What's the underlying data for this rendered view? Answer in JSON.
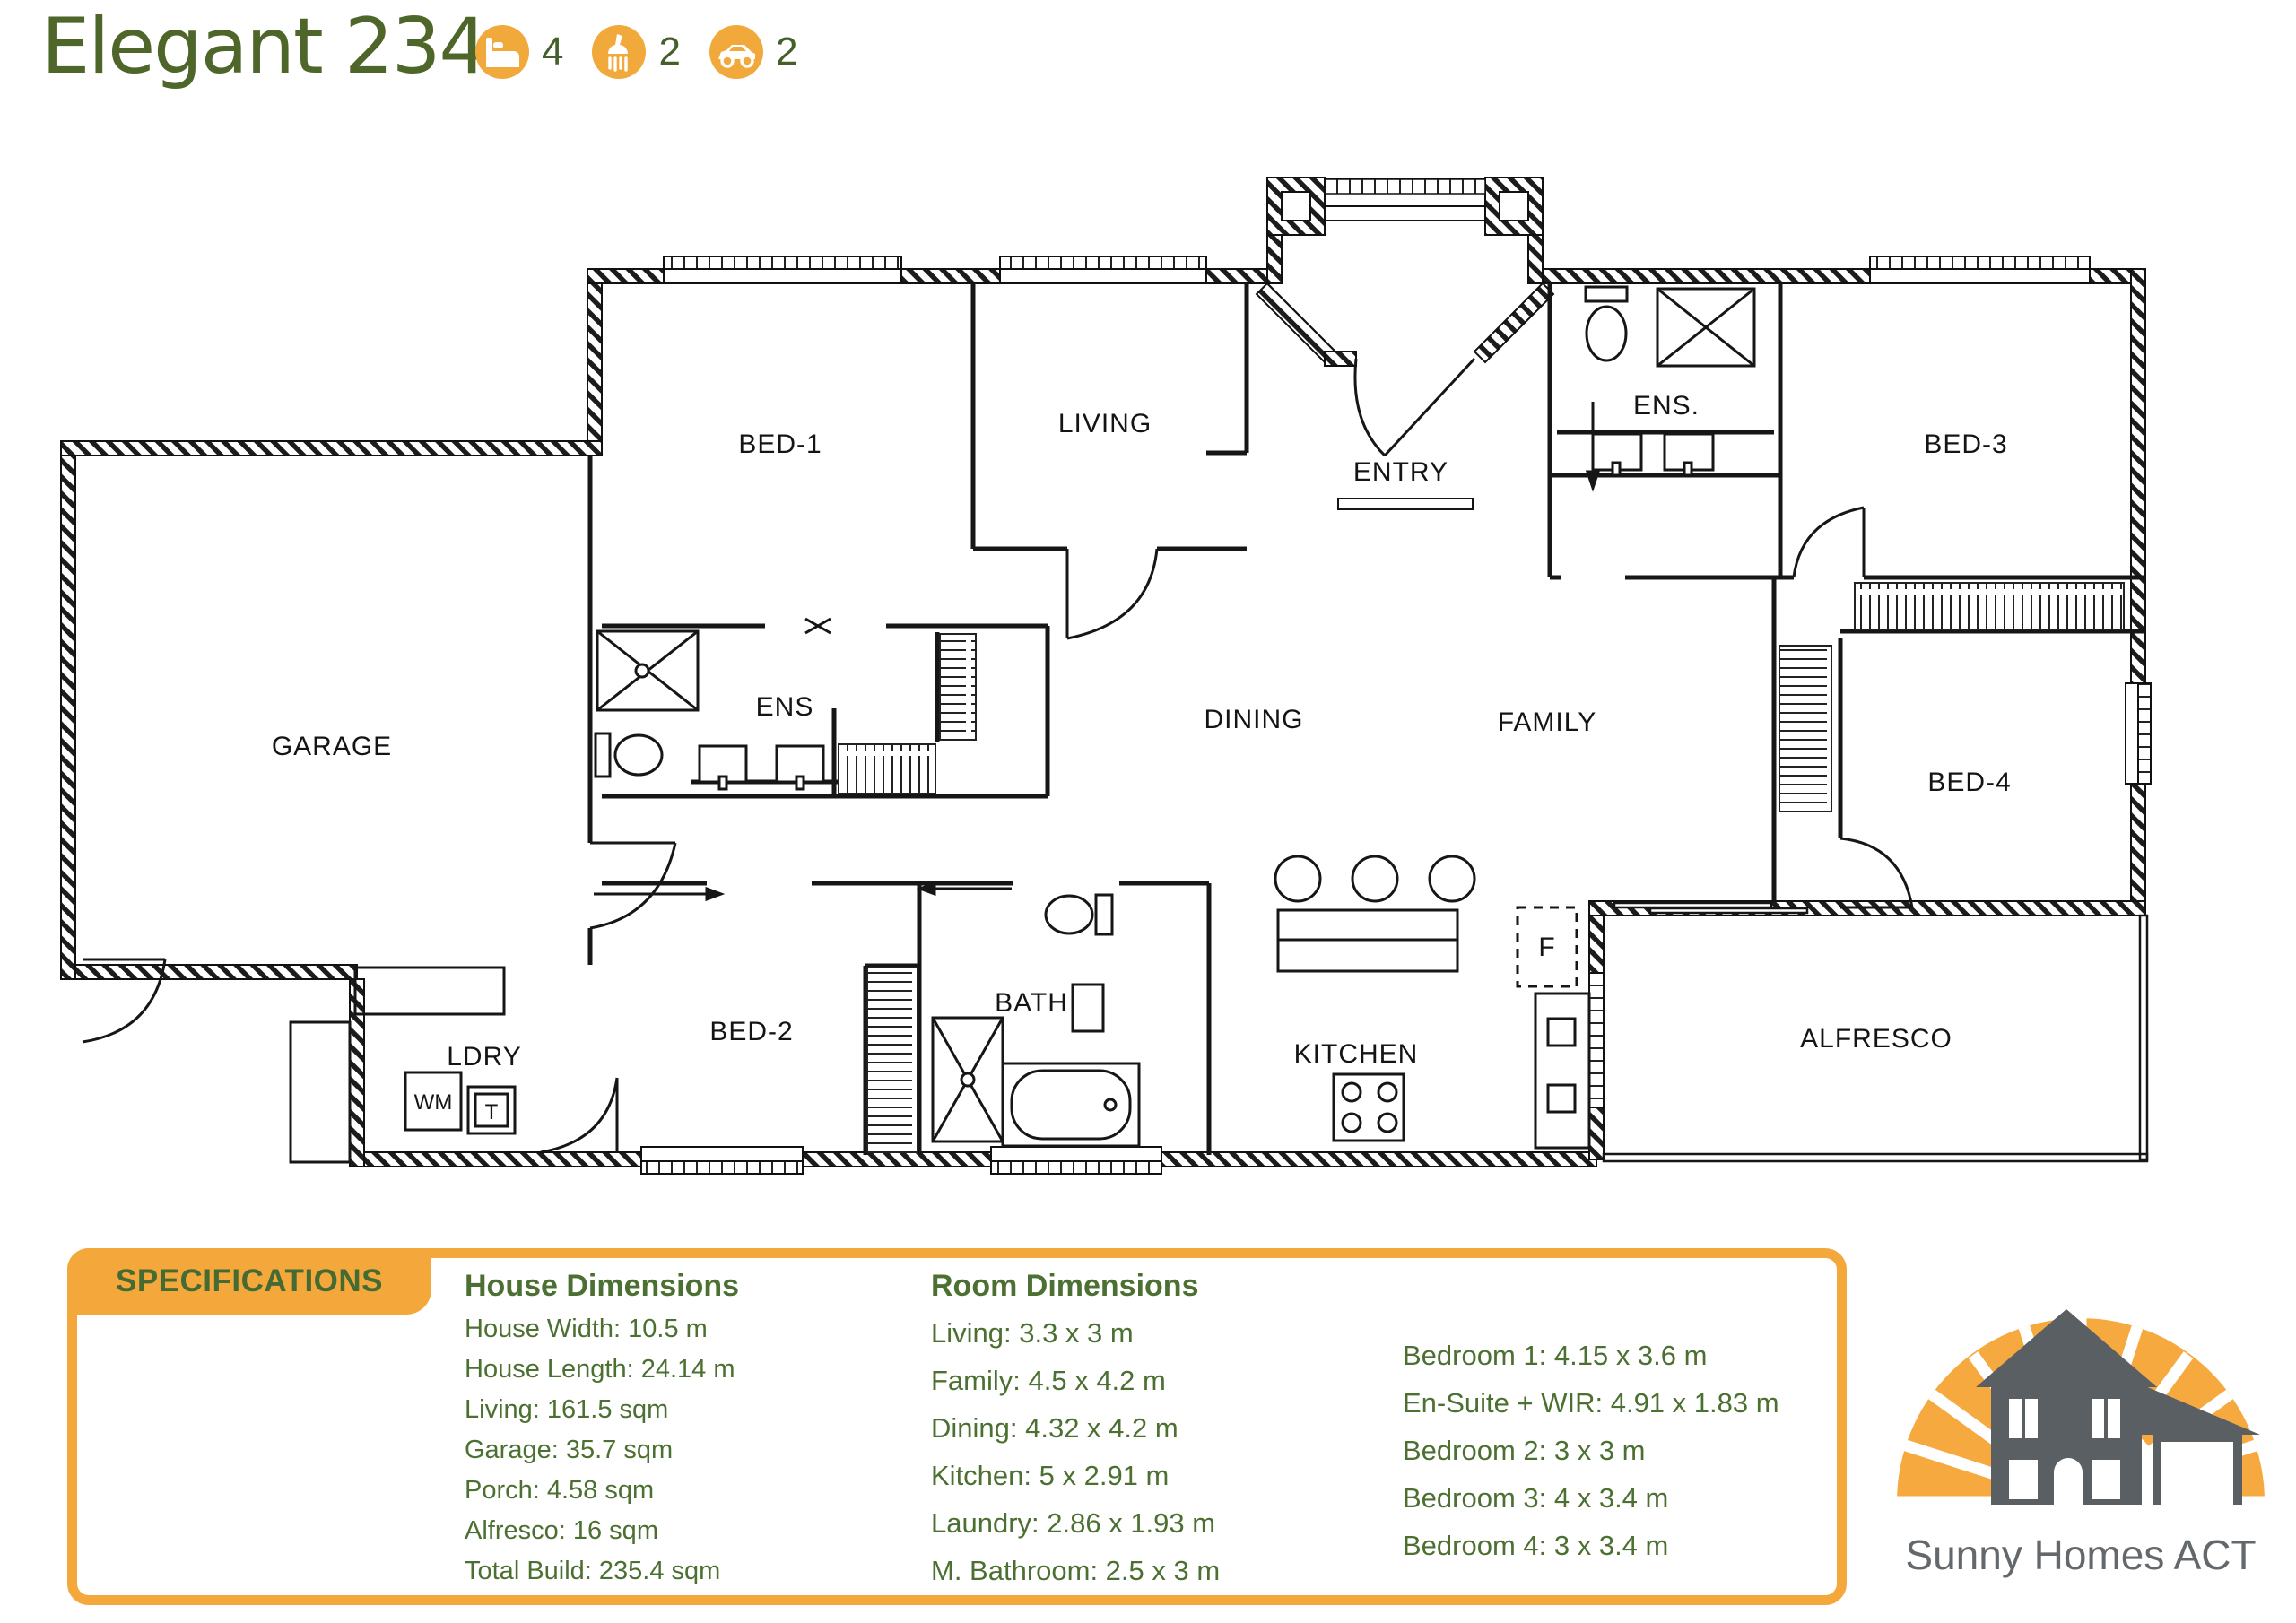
{
  "header": {
    "title": "Elegant 234",
    "features": {
      "beds": "4",
      "baths": "2",
      "cars": "2"
    }
  },
  "colors": {
    "accent_orange": "#F4A83C",
    "title_green": "#4F662B",
    "spec_text_green": "#4C7031",
    "logo_gray": "#5A5F63",
    "plan_line": "#161616"
  },
  "plan": {
    "rooms": {
      "garage": "GARAGE",
      "bed1": "BED-1",
      "living": "LIVING",
      "entry": "ENTRY",
      "ens3": "ENS.",
      "bed3": "BED-3",
      "ens_master": "ENS",
      "dining": "DINING",
      "family": "FAMILY",
      "bed4": "BED-4",
      "ldry": "LDRY",
      "bed2": "BED-2",
      "bath": "BATH",
      "kitchen": "KITCHEN",
      "alfresco": "ALFRESCO"
    },
    "fixtures": {
      "washing_machine": "WM",
      "tub_unit": "T",
      "fridge": "F"
    }
  },
  "specs": {
    "tab_label": "SPECIFICATIONS",
    "house_dimensions": {
      "header": "House Dimensions",
      "items": [
        "House Width: 10.5 m",
        "House Length: 24.14 m",
        "Living: 161.5 sqm",
        "Garage: 35.7 sqm",
        "Porch: 4.58 sqm",
        "Alfresco: 16 sqm",
        "Total Build: 235.4 sqm"
      ]
    },
    "room_dimensions": {
      "header": "Room Dimensions",
      "items": [
        "Living: 3.3 x 3 m",
        "Family: 4.5 x 4.2 m",
        "Dining: 4.32 x 4.2 m",
        "Kitchen: 5 x 2.91 m",
        "Laundry: 2.86 x 1.93 m",
        "M. Bathroom: 2.5 x 3 m"
      ]
    },
    "bedroom_dimensions": {
      "items": [
        "Bedroom 1: 4.15 x 3.6 m",
        "En-Suite + WIR: 4.91 x 1.83 m",
        "Bedroom 2: 3 x 3 m",
        "Bedroom 3: 4 x 3.4 m",
        "Bedroom 4: 3 x 3.4 m"
      ]
    }
  },
  "logo": {
    "company": "Sunny Homes ACT"
  }
}
